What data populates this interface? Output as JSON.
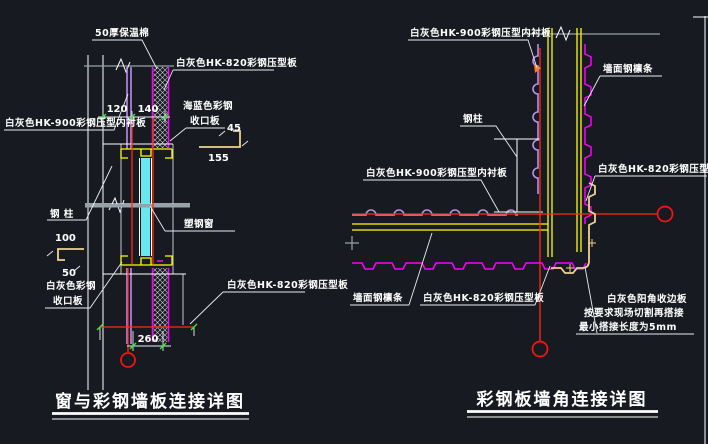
{
  "left": {
    "title": "窗与彩钢墙板连接详图",
    "labels": {
      "insulation": "50厚保温棉",
      "panel_outer_top": "白灰色HK-820彩钢压型板",
      "liner": "白灰色HK-900彩钢压型内衬板",
      "blue_closure_l1": "海蓝色彩钢",
      "blue_closure_l2": "收口板",
      "steel_column": "钢 柱",
      "white_closure_l1": "白灰色彩钢",
      "white_closure_l2": "收口板",
      "window": "塑钢窗",
      "panel_outer_bottom": "白灰色HK-820彩钢压型板"
    },
    "dims": {
      "gap_a": "120",
      "gap_b": "140",
      "head_closure_h": "45",
      "head_closure_w": "155",
      "sill_closure_w": "100",
      "sill_closure_h": "50",
      "opening_w": "260"
    }
  },
  "right": {
    "title": "彩钢板墙角连接详图",
    "labels": {
      "liner_top": "白灰色HK-900彩钢压型内衬板",
      "purlin_top": "墙面钢檩条",
      "steel_column": "钢柱",
      "panel_outer_right": "白灰色HK-820彩钢压型板",
      "liner_left": "白灰色HK-900彩钢压型内衬板",
      "purlin_bottom": "墙面钢檩条",
      "panel_outer_bottom": "白灰色HK-820彩钢压型板",
      "corner_note_l1": "白灰色阳角收边板",
      "corner_note_l2": "按要求现场切割再搭接",
      "corner_note_l3": "最小搭接长度为5mm"
    }
  },
  "colors": {
    "background": "#171b21",
    "line_white": "#ffffff",
    "cut_gray": "#99a1a9",
    "liner_purple": "#b98ef0",
    "panel_magenta": "#ff00ff",
    "purlin_yellow": "#ffff00",
    "flashing_tan": "#f0d191",
    "glass_cyan": "#66e8ee",
    "axis_red": "#ff2a12",
    "tick_green": "#27f32c"
  }
}
